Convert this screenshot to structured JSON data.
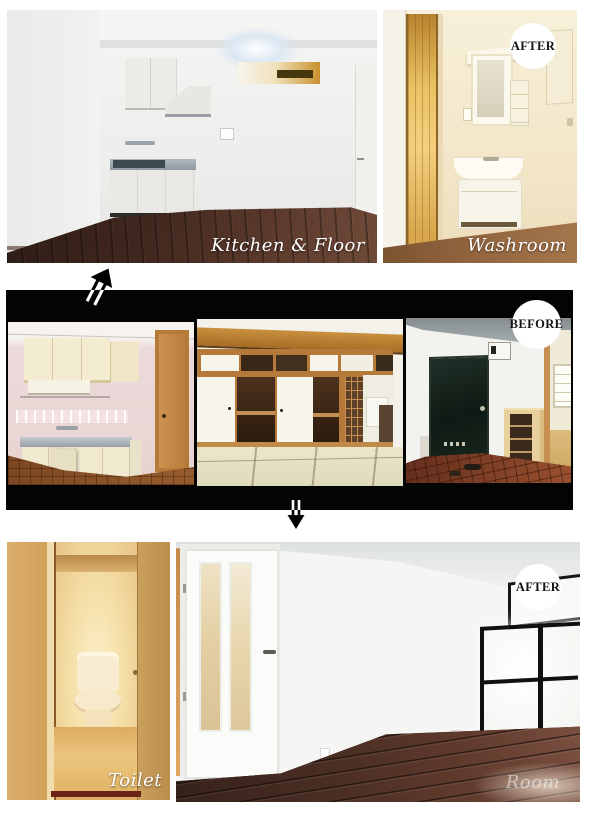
{
  "title": "Apartment renovation before and after photo collage",
  "badges": {
    "washroom_after": "AFTER",
    "before": "BEFORE",
    "room_after": "AFTER"
  },
  "labels": {
    "kitchen_floor": "Kitchen & Floor",
    "washroom": "Washroom",
    "toilet": "Toilet",
    "room": "Room"
  },
  "icons": {
    "up_arrow": "double-line arrow pointing up-right (before to after)",
    "down_arrow": "double-line arrow pointing down (before to after)"
  },
  "colors": {
    "page_background": "#ffffff",
    "strip_background": "#040404",
    "badge_background": "#ffffff",
    "badge_text": "#141414",
    "label_text": "#ffffff"
  }
}
